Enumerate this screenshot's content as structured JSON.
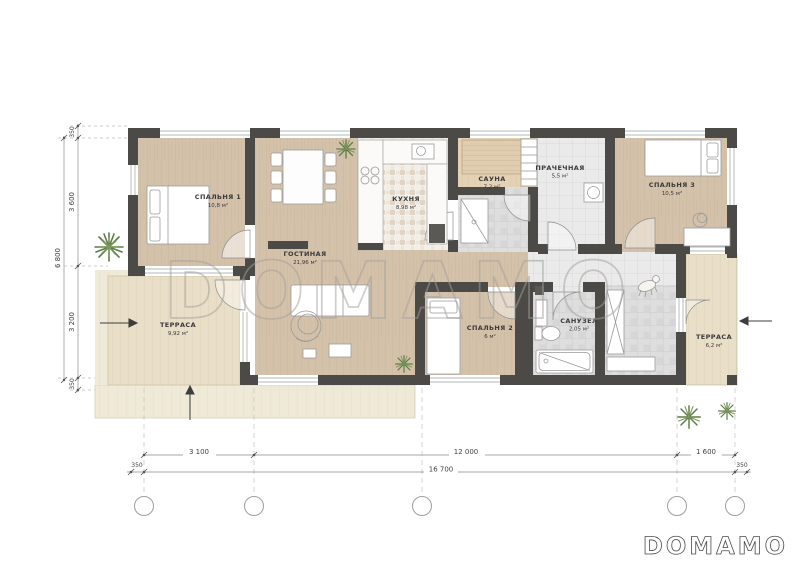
{
  "watermark": {
    "text": "DOMAMO"
  },
  "logo": {
    "text": "DOMAMO"
  },
  "rooms": [
    {
      "id": "bedroom1",
      "name": "СПАЛЬНЯ 1",
      "area": "10,8 м²"
    },
    {
      "id": "living",
      "name": "ГОСТИНАЯ",
      "area": "21,96 м²"
    },
    {
      "id": "kitchen",
      "name": "КУХНЯ",
      "area": "8,98 м²"
    },
    {
      "id": "sauna",
      "name": "САУНА",
      "area": "7,2 м²"
    },
    {
      "id": "laundry",
      "name": "ПРАЧЕЧНАЯ",
      "area": "5,5 м²"
    },
    {
      "id": "bedroom3",
      "name": "СПАЛЬНЯ 3",
      "area": "10,5 м²"
    },
    {
      "id": "terrace-left",
      "name": "ТЕРРАСА",
      "area": "9,92 м²"
    },
    {
      "id": "bedroom2",
      "name": "СПАЛЬНЯ 2",
      "area": "6 м²"
    },
    {
      "id": "bathroom",
      "name": "САНУЗЕЛ",
      "area": "2,05 м²"
    },
    {
      "id": "terrace-right",
      "name": "ТЕРРАСА",
      "area": "6,2 м²"
    }
  ],
  "dimensions": {
    "left": {
      "overall": "6 800",
      "segments": [
        "350",
        "3 600",
        "3 200",
        "350"
      ]
    },
    "bottom": {
      "overall": "16 700",
      "segments": [
        "3 100",
        "12 000",
        "1 600"
      ],
      "offsets": [
        "350",
        "350"
      ]
    }
  },
  "colors": {
    "wall": "#4b4a47",
    "wood_interior": "#d4c1aa",
    "wood_terrace": "#e9dfc8",
    "wood_deck": "#efe9d8",
    "tile_light": "#eaeaea",
    "tile_dark": "#dedede",
    "mosaic": "#ece5db",
    "watermark_gray": "#a3a09b",
    "plant_green": "#5d7c46"
  }
}
